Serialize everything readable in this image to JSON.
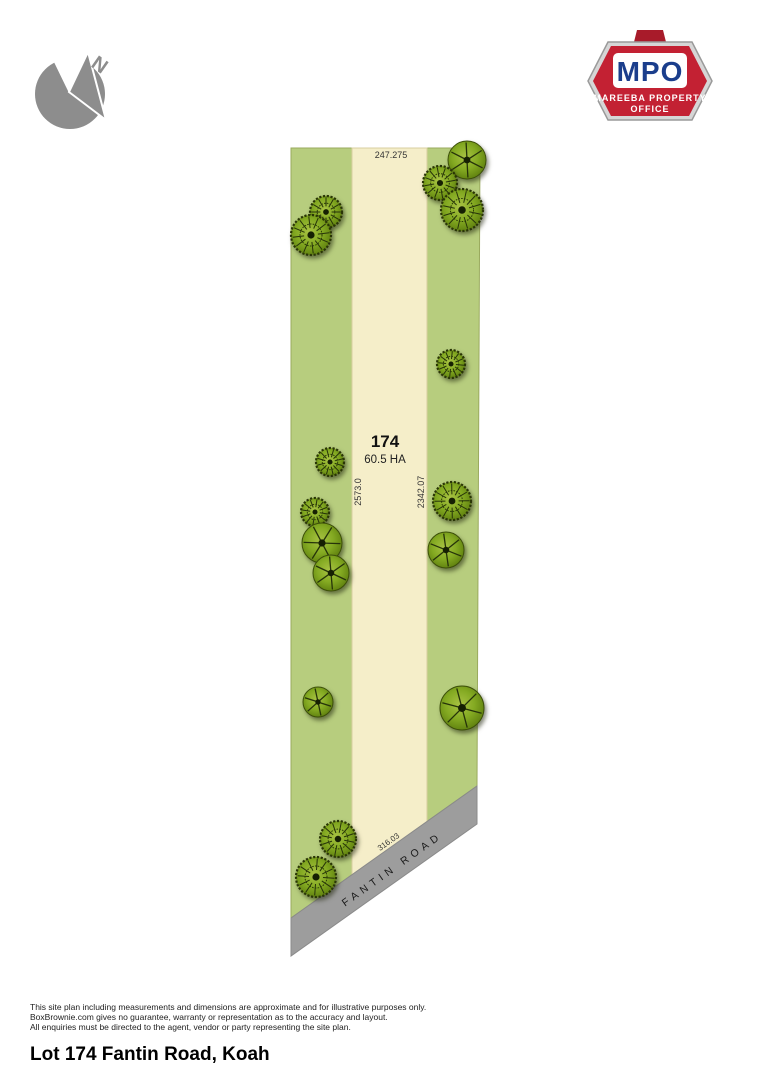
{
  "compass": {
    "letter": "N",
    "color": "#8d8d8d"
  },
  "logo": {
    "abbr": "MPO",
    "line1": "MAREEBA PROPERTY",
    "line2": "OFFICE",
    "colors": {
      "red": "#c32133",
      "dark_red": "#a81b2a",
      "blue": "#1b3e8c",
      "silver": "#d6d6d6"
    }
  },
  "plan": {
    "lot_number": "174",
    "area": "60.5 HA",
    "dim_top": "247.275",
    "dim_left": "2573.0",
    "dim_right": "2342.07",
    "dim_bottom": "316.03",
    "road_name": "FANTIN ROAD",
    "colors": {
      "grass": "#b7cd7e",
      "clearing": "#f5eec9",
      "road": "#9d9d9d",
      "grass_outline": "#9aaa5e",
      "clearing_outline": "#d8cfa0",
      "tree_green": "#84aa22"
    },
    "shapes": {
      "lot": "291,148 480,148 477,786 291,918",
      "clearing": "352,148 427,148 427,822 352,875",
      "road": "477,786 477,824 291,956 291,918"
    },
    "trees": [
      {
        "x": 326,
        "y": 212,
        "r": 16,
        "v": "b"
      },
      {
        "x": 311,
        "y": 235,
        "r": 20,
        "v": "b"
      },
      {
        "x": 330,
        "y": 462,
        "r": 14,
        "v": "b"
      },
      {
        "x": 315,
        "y": 512,
        "r": 14,
        "v": "b"
      },
      {
        "x": 322,
        "y": 543,
        "r": 20,
        "v": "a"
      },
      {
        "x": 331,
        "y": 573,
        "r": 18,
        "v": "a"
      },
      {
        "x": 318,
        "y": 702,
        "r": 15,
        "v": "a"
      },
      {
        "x": 338,
        "y": 839,
        "r": 18,
        "v": "b"
      },
      {
        "x": 316,
        "y": 877,
        "r": 20,
        "v": "b"
      },
      {
        "x": 467,
        "y": 160,
        "r": 19,
        "v": "a"
      },
      {
        "x": 440,
        "y": 183,
        "r": 17,
        "v": "b"
      },
      {
        "x": 462,
        "y": 210,
        "r": 21,
        "v": "b"
      },
      {
        "x": 451,
        "y": 364,
        "r": 14,
        "v": "b"
      },
      {
        "x": 452,
        "y": 501,
        "r": 19,
        "v": "b"
      },
      {
        "x": 446,
        "y": 550,
        "r": 18,
        "v": "a"
      },
      {
        "x": 462,
        "y": 708,
        "r": 22,
        "v": "a"
      }
    ]
  },
  "footer": {
    "disclaimer_lines": [
      "This site plan including measurements and dimensions are approximate and for illustrative purposes only.",
      "BoxBrownie.com gives no guarantee, warranty or representation as to the accuracy and layout.",
      "All enquiries must be directed to the agent, vendor or party representing the site plan."
    ],
    "title": "Lot 174 Fantin Road, Koah"
  }
}
